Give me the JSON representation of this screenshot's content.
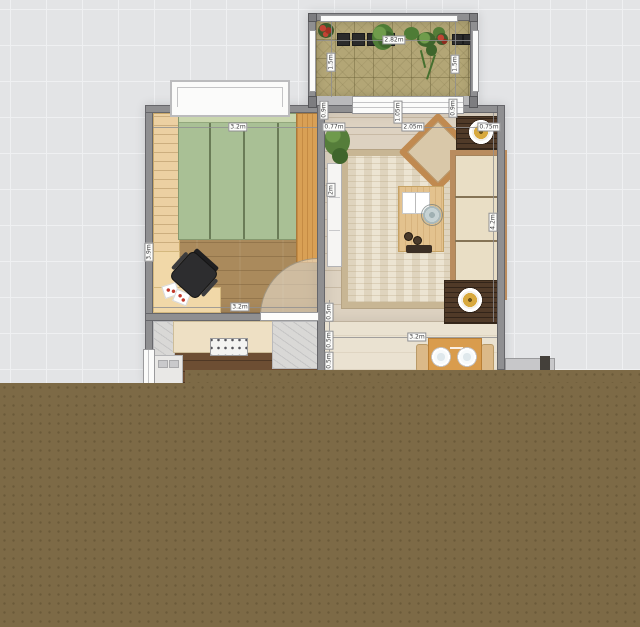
{
  "palette": {
    "background": "#e3e4e6",
    "grid_line": "#eff0f2",
    "unrendered_area": "#7d6a46",
    "wall": "#8f8f91",
    "window_white": "#fbfbfa",
    "bed_green": "#a9c095",
    "bed_seam": "#6a7c57",
    "wardrobe_wood": "#ecd0a2",
    "dresser_wood": "#d9a055",
    "desk_wood": "#f1d8a8",
    "bedroom_floor": "#aa8a5c",
    "kitchen_floor": "#6d4e33",
    "living_floor": "#ddd2c1",
    "hall_floor": "#eae2d1",
    "balcony_tile": "#b3a676",
    "rug_base": "#ece4d2",
    "rug_border": "#c8b694",
    "sofa_wood": "#b98c5e",
    "cushion": "#e9dec5",
    "table_wood": "#e3c28e",
    "tray_dark": "#503a28",
    "marble": "#d9d8d6"
  },
  "measurements": [
    {
      "text": "2.82m",
      "x": 394,
      "y": 40,
      "vertical": false
    },
    {
      "text": "1.5m",
      "x": 331,
      "y": 62,
      "vertical": true
    },
    {
      "text": "1.5m",
      "x": 455,
      "y": 64,
      "vertical": true
    },
    {
      "text": "0.9m",
      "x": 453,
      "y": 108,
      "vertical": true
    },
    {
      "text": "0.9m",
      "x": 324,
      "y": 110,
      "vertical": true
    },
    {
      "text": "1.05m",
      "x": 398,
      "y": 112,
      "vertical": true
    },
    {
      "text": "3.2m",
      "x": 238,
      "y": 127,
      "vertical": false
    },
    {
      "text": "0.77m",
      "x": 334,
      "y": 127,
      "vertical": false
    },
    {
      "text": "2.05m",
      "x": 413,
      "y": 127,
      "vertical": false
    },
    {
      "text": "0.75m",
      "x": 489,
      "y": 127,
      "vertical": false
    },
    {
      "text": "2m",
      "x": 331,
      "y": 190,
      "vertical": true
    },
    {
      "text": "4.2m",
      "x": 493,
      "y": 222,
      "vertical": true
    },
    {
      "text": "3.9m",
      "x": 149,
      "y": 252,
      "vertical": true
    },
    {
      "text": "3.2m",
      "x": 240,
      "y": 307,
      "vertical": false
    },
    {
      "text": "0.5m",
      "x": 329,
      "y": 312,
      "vertical": true
    },
    {
      "text": "3.2m",
      "x": 417,
      "y": 337,
      "vertical": false
    },
    {
      "text": "0.5m",
      "x": 329,
      "y": 340,
      "vertical": true
    },
    {
      "text": "0.5m",
      "x": 329,
      "y": 361,
      "vertical": true
    }
  ],
  "measure_lines": [
    {
      "x": 153,
      "y": 127,
      "len": 164,
      "vertical": false
    },
    {
      "x": 325,
      "y": 127,
      "len": 172,
      "vertical": false
    },
    {
      "x": 317,
      "y": 40,
      "len": 154,
      "vertical": false
    },
    {
      "x": 153,
      "y": 307,
      "len": 164,
      "vertical": false
    },
    {
      "x": 327,
      "y": 337,
      "len": 170,
      "vertical": false
    },
    {
      "x": 493,
      "y": 113,
      "len": 209,
      "vertical": true
    },
    {
      "x": 331,
      "y": 21,
      "len": 76,
      "vertical": true
    },
    {
      "x": 455,
      "y": 21,
      "len": 76,
      "vertical": true
    },
    {
      "x": 149,
      "y": 113,
      "len": 200,
      "vertical": true
    },
    {
      "x": 329,
      "y": 300,
      "len": 83,
      "vertical": true
    }
  ]
}
